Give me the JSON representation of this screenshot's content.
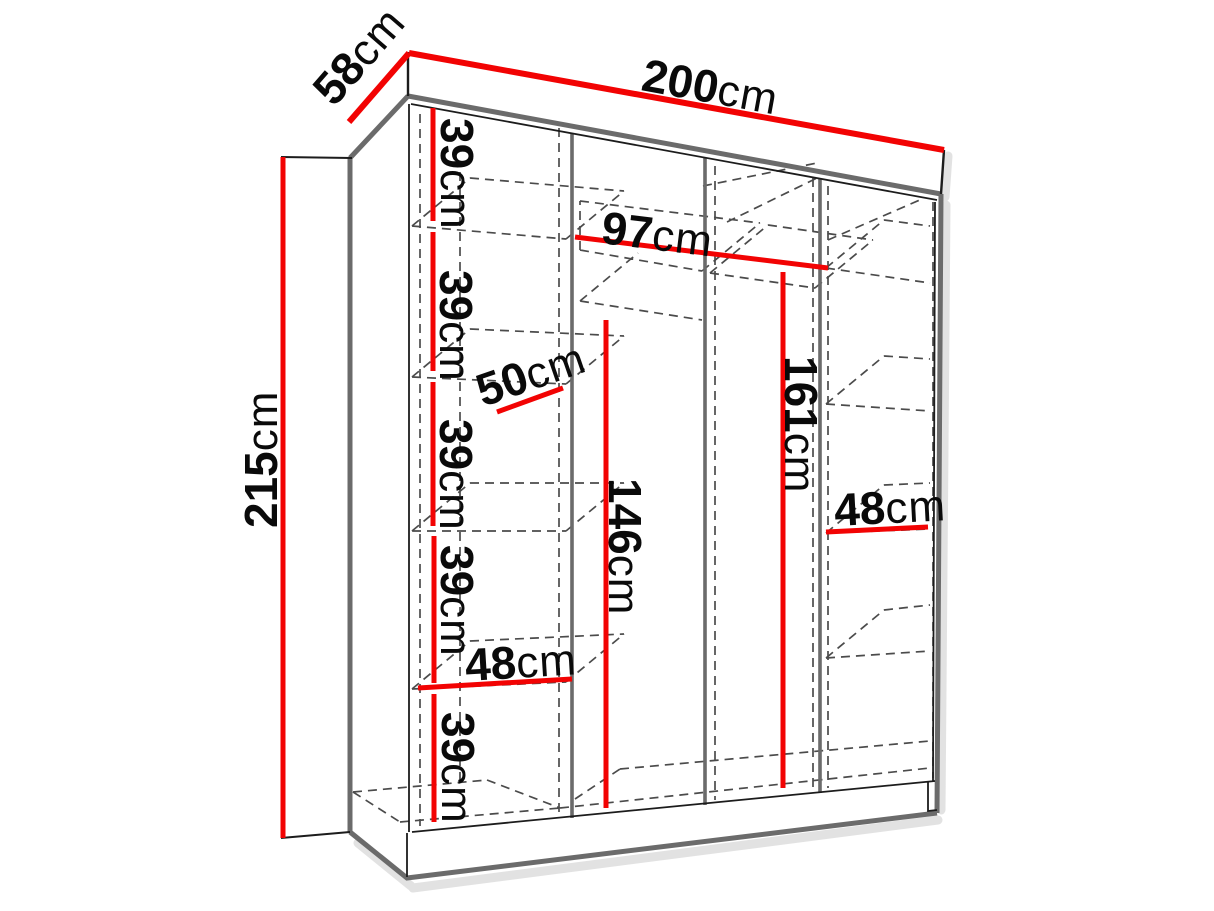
{
  "diagram": {
    "type": "furniture-dimension-diagram",
    "subject": "three-section wardrobe interior with shelves and hanging space, perspective line drawing",
    "canvas": {
      "width": 1214,
      "height": 911
    },
    "colors": {
      "dimension": "#f20303",
      "frame": "#6b6b6b",
      "edge": "#1c1c1c",
      "hidden": "#4b4b4b",
      "text": "#0a0a0a",
      "shadow": "#c6c6c6",
      "background": "#ffffff"
    },
    "dims": {
      "total_width": {
        "num": "200",
        "unit": "cm"
      },
      "total_depth": {
        "num": "58",
        "unit": "cm"
      },
      "total_height": {
        "num": "215",
        "unit": "cm"
      },
      "gap1": {
        "num": "39",
        "unit": "cm"
      },
      "gap2": {
        "num": "39",
        "unit": "cm"
      },
      "gap3": {
        "num": "39",
        "unit": "cm"
      },
      "gap4": {
        "num": "39",
        "unit": "cm"
      },
      "gap5": {
        "num": "39",
        "unit": "cm"
      },
      "shelf_depth": {
        "num": "50",
        "unit": "cm"
      },
      "left_width": {
        "num": "48",
        "unit": "cm"
      },
      "middle_width": {
        "num": "97",
        "unit": "cm"
      },
      "middle_left_height": {
        "num": "146",
        "unit": "cm"
      },
      "middle_right_height": {
        "num": "161",
        "unit": "cm"
      },
      "right_width": {
        "num": "48",
        "unit": "cm"
      }
    }
  }
}
